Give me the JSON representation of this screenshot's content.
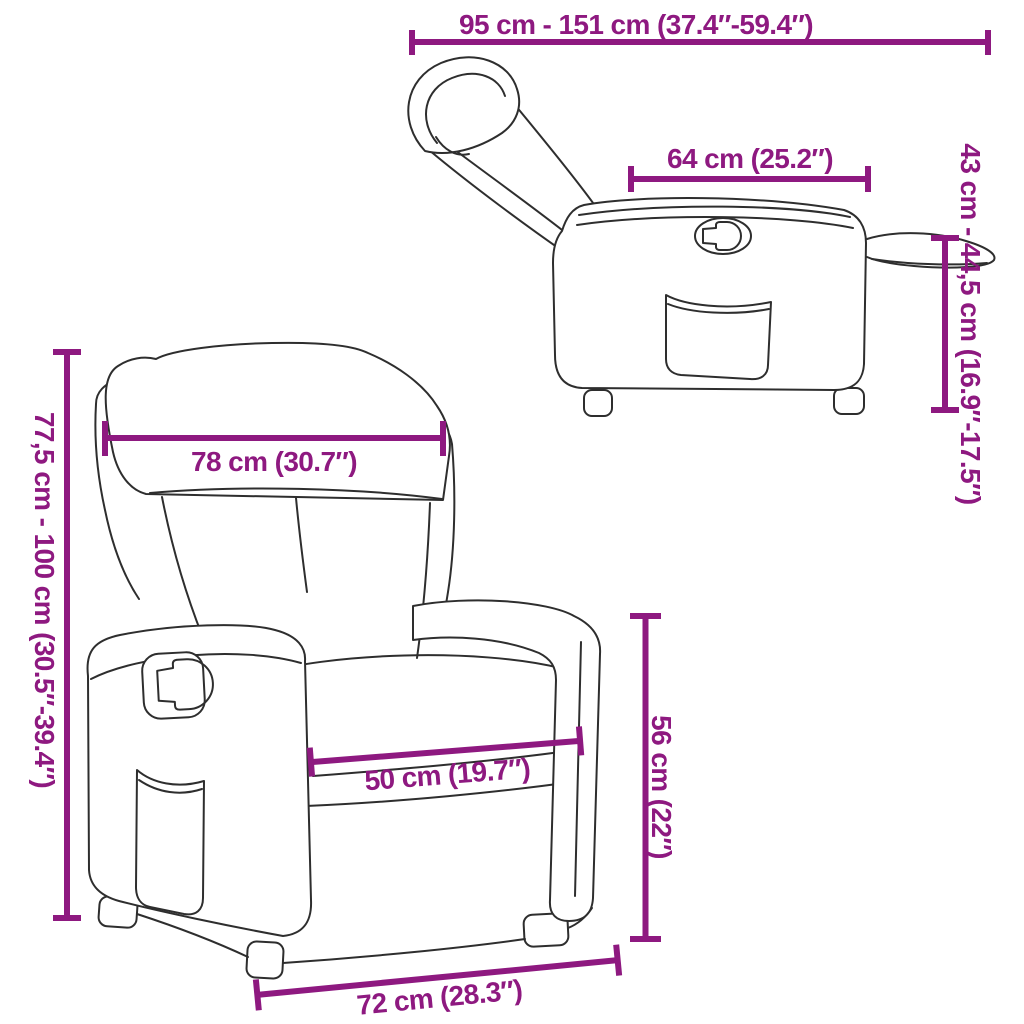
{
  "colors": {
    "accent": "#8E1980",
    "line_art": "#2E2E2E",
    "background": "#FFFFFF"
  },
  "diagram": {
    "product": "recliner-chair",
    "views": {
      "front_view": "front view of recliner",
      "side_view": "side view of reclined recliner with footrest extended"
    }
  },
  "dimensions": {
    "reclined_length": {
      "label": "95 cm - 151 cm (37.4″-59.4″)"
    },
    "seat_top_depth": {
      "label": "64 cm (25.2″)"
    },
    "footrest_height_range": {
      "label": "43 cm - 44,5 cm (16.9″-17.5″)"
    },
    "total_height_range": {
      "label": "77,5 cm - 100 cm (30.5″-39.4″)"
    },
    "backrest_width": {
      "label": "78 cm (30.7″)"
    },
    "seat_width": {
      "label": "50 cm (19.7″)"
    },
    "seat_height": {
      "label": "56 cm (22″)"
    },
    "base_width": {
      "label": "72 cm (28.3″)"
    }
  }
}
